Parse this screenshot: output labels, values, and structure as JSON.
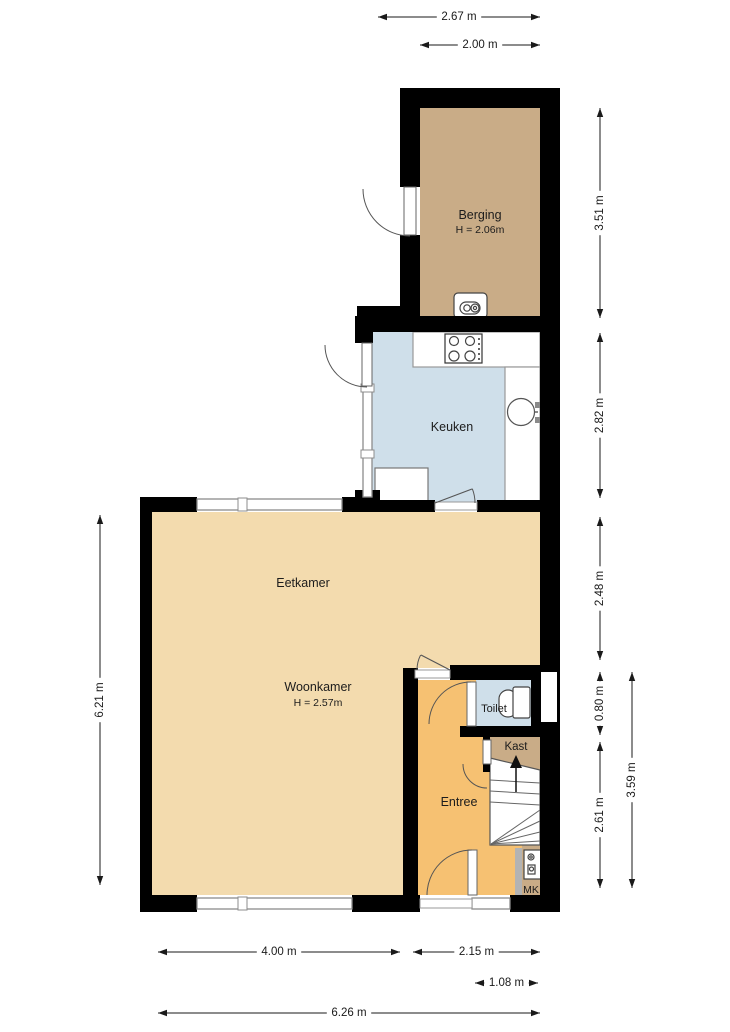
{
  "meta": {
    "type": "floor-plan",
    "language": "nl"
  },
  "palette": {
    "wall": "#000000",
    "tan": "#c9ac87",
    "blue": "#cfdfea",
    "beige": "#f3dbae",
    "orange": "#f6c172",
    "white": "#ffffff",
    "window_gray": "#8c8c8c",
    "fixture_line": "#444444",
    "stair_line": "#666666",
    "dim_color": "#1a1a1a",
    "label_color": "#1c1c1c"
  },
  "rooms": [
    {
      "name": "berging",
      "prims": [
        {
          "t": "rect",
          "x": 420,
          "y": 108,
          "w": 120,
          "h": 210,
          "f": "tan"
        }
      ]
    },
    {
      "name": "keuken",
      "prims": [
        {
          "t": "rect",
          "x": 372,
          "y": 332,
          "w": 168,
          "h": 171,
          "f": "blue"
        }
      ]
    },
    {
      "name": "eetkamer-woonkamer",
      "prims": [
        {
          "t": "poly",
          "pts": "152,512 540,512 540,668 418,668 418,895 152,895",
          "f": "beige"
        }
      ]
    },
    {
      "name": "entree",
      "prims": [
        {
          "t": "rect",
          "x": 418,
          "y": 680,
          "w": 122,
          "h": 215,
          "f": "orange"
        }
      ]
    },
    {
      "name": "toilet",
      "prims": [
        {
          "t": "rect",
          "x": 476,
          "y": 680,
          "w": 55,
          "h": 46,
          "f": "blue"
        }
      ]
    },
    {
      "name": "kast",
      "prims": [
        {
          "t": "poly",
          "pts": "490,737 540,737 540,770 490,758",
          "f": "tan"
        }
      ]
    },
    {
      "name": "mk-nook",
      "prims": [
        {
          "t": "rect",
          "x": 522,
          "y": 845,
          "w": 18,
          "h": 50,
          "f": "tan"
        }
      ]
    }
  ],
  "fixtures": [
    {
      "name": "kitchen-counter-top",
      "prims": [
        {
          "t": "rect",
          "x": 413,
          "y": 332,
          "w": 127,
          "h": 35,
          "f": "white",
          "s": "#999999"
        }
      ]
    },
    {
      "name": "kitchen-counter-right",
      "prims": [
        {
          "t": "rect",
          "x": 505,
          "y": 367,
          "w": 35,
          "h": 137,
          "f": "white",
          "s": "#999999"
        }
      ]
    },
    {
      "name": "kitchen-cabinet",
      "prims": [
        {
          "t": "rect",
          "x": 375,
          "y": 468,
          "w": 53,
          "h": 37,
          "f": "white",
          "s": "#777777"
        }
      ]
    },
    {
      "name": "stove",
      "prims": [
        {
          "t": "rect",
          "x": 445,
          "y": 334,
          "w": 37,
          "h": 29,
          "f": "white",
          "s": "#333333"
        },
        {
          "t": "circle",
          "cx": 454,
          "cy": 341,
          "r": 4.5,
          "f": "none",
          "s": "#444444"
        },
        {
          "t": "circle",
          "cx": 470,
          "cy": 341,
          "r": 4.5,
          "f": "none",
          "s": "#444444"
        },
        {
          "t": "circle",
          "cx": 454,
          "cy": 356,
          "r": 5,
          "f": "none",
          "s": "#444444"
        },
        {
          "t": "circle",
          "cx": 470,
          "cy": 356,
          "r": 5,
          "f": "none",
          "s": "#444444"
        },
        {
          "t": "circle",
          "cx": 479,
          "cy": 339,
          "r": 1,
          "f": "#333333"
        },
        {
          "t": "circle",
          "cx": 479,
          "cy": 344,
          "r": 1,
          "f": "#333333"
        },
        {
          "t": "circle",
          "cx": 479,
          "cy": 349,
          "r": 1,
          "f": "#333333"
        },
        {
          "t": "circle",
          "cx": 479,
          "cy": 354,
          "r": 1,
          "f": "#333333"
        },
        {
          "t": "circle",
          "cx": 479,
          "cy": 359,
          "r": 1,
          "f": "#333333"
        }
      ]
    },
    {
      "name": "sink",
      "prims": [
        {
          "t": "line",
          "x1": 522,
          "y1": 412,
          "x2": 538,
          "y2": 412,
          "s": "#8a8a8a",
          "sw": 2
        },
        {
          "t": "circle",
          "cx": 521,
          "cy": 412,
          "r": 13.5,
          "f": "white",
          "s": "#555555"
        },
        {
          "t": "rect",
          "x": 535,
          "y": 402,
          "w": 7,
          "h": 6,
          "f": "#8a8a8a"
        },
        {
          "t": "rect",
          "x": 535,
          "y": 417,
          "w": 7,
          "h": 6,
          "f": "#8a8a8a"
        }
      ]
    },
    {
      "name": "boiler",
      "prims": [
        {
          "t": "rect",
          "x": 454,
          "y": 293,
          "w": 33,
          "h": 25,
          "rx": 4,
          "f": "white",
          "s": "#444444"
        },
        {
          "t": "rect",
          "x": 460,
          "y": 302,
          "w": 20,
          "h": 12,
          "rx": 6,
          "f": "white",
          "s": "#444444"
        },
        {
          "t": "circle",
          "cx": 467,
          "cy": 308,
          "r": 3.2,
          "f": "none",
          "s": "#444444"
        },
        {
          "t": "circle",
          "cx": 475,
          "cy": 308,
          "r": 4,
          "f": "none",
          "s": "#444444"
        },
        {
          "t": "circle",
          "cx": 475,
          "cy": 308,
          "r": 1.6,
          "f": "none",
          "s": "#444444"
        }
      ]
    },
    {
      "name": "toilet-fixture",
      "prims": [
        {
          "t": "rect",
          "x": 499,
          "y": 690,
          "w": 18,
          "h": 27,
          "rx": 9,
          "f": "white",
          "s": "#444444"
        },
        {
          "t": "rect",
          "x": 513,
          "y": 687,
          "w": 17,
          "h": 31,
          "rx": 2,
          "f": "white",
          "s": "#444444"
        }
      ]
    },
    {
      "name": "staircase",
      "prims": [
        {
          "t": "poly",
          "pts": "490,758 540,770 540,845 490,845",
          "f": "white",
          "s": "#555555"
        },
        {
          "t": "line",
          "x1": 490,
          "y1": 780,
          "x2": 540,
          "y2": 783,
          "s": "#666666"
        },
        {
          "t": "line",
          "x1": 490,
          "y1": 791,
          "x2": 540,
          "y2": 794,
          "s": "#666666"
        },
        {
          "t": "line",
          "x1": 490,
          "y1": 802,
          "x2": 540,
          "y2": 805,
          "s": "#666666"
        },
        {
          "t": "line",
          "x1": 491,
          "y1": 844,
          "x2": 540,
          "y2": 810,
          "s": "#666666"
        },
        {
          "t": "line",
          "x1": 491,
          "y1": 844,
          "x2": 540,
          "y2": 821,
          "s": "#666666"
        },
        {
          "t": "line",
          "x1": 491,
          "y1": 844,
          "x2": 540,
          "y2": 832,
          "s": "#666666"
        },
        {
          "t": "line",
          "x1": 491,
          "y1": 844,
          "x2": 540,
          "y2": 841,
          "s": "#666666"
        },
        {
          "t": "line",
          "x1": 516,
          "y1": 792,
          "x2": 516,
          "y2": 766,
          "s": "#111111",
          "sw": 1.5
        },
        {
          "t": "poly",
          "pts": "510,768 522,768 516,755",
          "f": "#111111"
        }
      ]
    },
    {
      "name": "meter-cabinet",
      "prims": [
        {
          "t": "rect",
          "x": 515,
          "y": 848,
          "w": 7,
          "h": 47,
          "f": "#b3b3b3"
        },
        {
          "t": "rect",
          "x": 524,
          "y": 850,
          "w": 17,
          "h": 29,
          "f": "white",
          "s": "#444444"
        },
        {
          "t": "circle",
          "cx": 531,
          "cy": 857,
          "r": 3,
          "f": "none",
          "s": "#444444"
        },
        {
          "t": "circle",
          "cx": 531,
          "cy": 857,
          "r": 1.2,
          "f": "none",
          "s": "#444444"
        },
        {
          "t": "rect",
          "x": 528,
          "y": 865,
          "w": 7,
          "h": 9,
          "f": "white",
          "s": "#444444"
        },
        {
          "t": "circle",
          "cx": 531.5,
          "cy": 869,
          "r": 2,
          "f": "none",
          "s": "#444444"
        }
      ]
    }
  ],
  "walls": [
    [
      400,
      88,
      160,
      20
    ],
    [
      400,
      108,
      20,
      79
    ],
    [
      400,
      235,
      20,
      95
    ],
    [
      540,
      88,
      20,
      824
    ],
    [
      357,
      306,
      43,
      10
    ],
    [
      355,
      316,
      205,
      16
    ],
    [
      355,
      332,
      18,
      11
    ],
    [
      355,
      490,
      25,
      22
    ],
    [
      140,
      497,
      57,
      15
    ],
    [
      342,
      497,
      38,
      15
    ],
    [
      368,
      500,
      67,
      12
    ],
    [
      477,
      500,
      63,
      12
    ],
    [
      140,
      497,
      12,
      415
    ],
    [
      140,
      895,
      57,
      17
    ],
    [
      352,
      895,
      68,
      17
    ],
    [
      510,
      895,
      50,
      17
    ],
    [
      403,
      668,
      15,
      227
    ],
    [
      450,
      665,
      90,
      15
    ],
    [
      460,
      726,
      83,
      11
    ],
    [
      531,
      680,
      10,
      46
    ],
    [
      483,
      737,
      7,
      35
    ]
  ],
  "notches": [
    [
      541,
      672,
      16,
      50
    ]
  ],
  "windows": [
    {
      "x": 197,
      "y": 499,
      "w": 145,
      "h": 11,
      "dividers": [
        [
          238,
          498,
          9,
          13
        ]
      ]
    },
    {
      "x": 197,
      "y": 898,
      "w": 155,
      "h": 11,
      "dividers": [
        [
          238,
          897,
          9,
          13
        ]
      ]
    },
    {
      "x": 472,
      "y": 898,
      "w": 38,
      "h": 11,
      "dividers": []
    },
    {
      "x": 363,
      "y": 386,
      "w": 9,
      "h": 111,
      "dividers": [
        [
          361,
          384,
          13,
          8
        ],
        [
          361,
          450,
          13,
          8
        ]
      ]
    }
  ],
  "sills": [
    [
      435,
      502,
      42,
      8
    ],
    [
      415,
      670,
      35,
      8
    ],
    [
      420,
      899,
      52,
      9
    ]
  ],
  "door_leaves": [
    [
      404,
      187,
      12,
      48
    ],
    [
      362,
      343,
      10,
      43
    ],
    [
      467,
      682,
      9,
      44
    ],
    [
      483,
      740,
      8,
      24
    ],
    [
      468,
      850,
      9,
      45
    ]
  ],
  "door_arcs": [
    {
      "cx": 410,
      "cy": 189,
      "r": 47,
      "a1": 180,
      "a2": 90
    },
    {
      "cx": 367,
      "cy": 345,
      "r": 42,
      "a1": 180,
      "a2": 90
    },
    {
      "cx": 471,
      "cy": 724,
      "r": 42,
      "a1": 270,
      "a2": 180
    },
    {
      "cx": 487,
      "cy": 764,
      "r": 24,
      "a1": 180,
      "a2": 90
    },
    {
      "cx": 472,
      "cy": 895,
      "r": 45,
      "a1": 270,
      "a2": 180
    },
    {
      "cx": 450,
      "cy": 670,
      "r": 33,
      "a1": 207,
      "a2": 180
    },
    {
      "cx": 435,
      "cy": 503,
      "r": 40,
      "a1": -21,
      "a2": 0
    }
  ],
  "door_lines": [
    [
      450,
      670,
      421,
      655
    ],
    [
      435,
      503,
      472,
      489
    ]
  ],
  "labels": [
    {
      "name": "berging-label",
      "text": "Berging",
      "x": 480,
      "y": 215,
      "size": 12.5
    },
    {
      "name": "berging-height",
      "text": "H = 2.06m",
      "x": 480,
      "y": 230,
      "size": 10.5
    },
    {
      "name": "keuken-label",
      "text": "Keuken",
      "x": 452,
      "y": 427,
      "size": 12.5
    },
    {
      "name": "eetkamer-label",
      "text": "Eetkamer",
      "x": 303,
      "y": 583,
      "size": 12.5
    },
    {
      "name": "woonkamer-label",
      "text": "Woonkamer",
      "x": 318,
      "y": 687,
      "size": 12.5
    },
    {
      "name": "woonkamer-height",
      "text": "H = 2.57m",
      "x": 318,
      "y": 703,
      "size": 10.5
    },
    {
      "name": "toilet-label",
      "text": "Toilet",
      "x": 494,
      "y": 709,
      "size": 11
    },
    {
      "name": "kast-label",
      "text": "Kast",
      "x": 516,
      "y": 747,
      "size": 11.5
    },
    {
      "name": "entree-label",
      "text": "Entree",
      "x": 459,
      "y": 802,
      "size": 12.5
    },
    {
      "name": "mk-label",
      "text": "MK",
      "x": 531,
      "y": 890,
      "size": 10.5
    }
  ],
  "dimensions": {
    "horizontal": [
      {
        "y": 17,
        "x1": 378,
        "x2": 540,
        "label": "2.67 m"
      },
      {
        "y": 45,
        "x1": 420,
        "x2": 540,
        "label": "2.00 m"
      },
      {
        "y": 952,
        "x1": 158,
        "x2": 400,
        "label": "4.00 m"
      },
      {
        "y": 952,
        "x1": 413,
        "x2": 540,
        "label": "2.15 m"
      },
      {
        "y": 983,
        "x1": 475,
        "x2": 538,
        "label": "1.08 m"
      },
      {
        "y": 1013,
        "x1": 158,
        "x2": 540,
        "label": "6.26 m"
      }
    ],
    "vertical": [
      {
        "x": 100,
        "y1": 515,
        "y2": 885,
        "label": "6.21 m"
      },
      {
        "x": 600,
        "y1": 108,
        "y2": 318,
        "label": "3.51 m"
      },
      {
        "x": 600,
        "y1": 333,
        "y2": 498,
        "label": "2.82 m"
      },
      {
        "x": 600,
        "y1": 517,
        "y2": 660,
        "label": "2.48 m"
      },
      {
        "x": 600,
        "y1": 672,
        "y2": 735,
        "label": "0.80 m"
      },
      {
        "x": 600,
        "y1": 742,
        "y2": 888,
        "label": "2.61 m"
      },
      {
        "x": 632,
        "y1": 672,
        "y2": 888,
        "label": "3.59 m"
      }
    ]
  }
}
